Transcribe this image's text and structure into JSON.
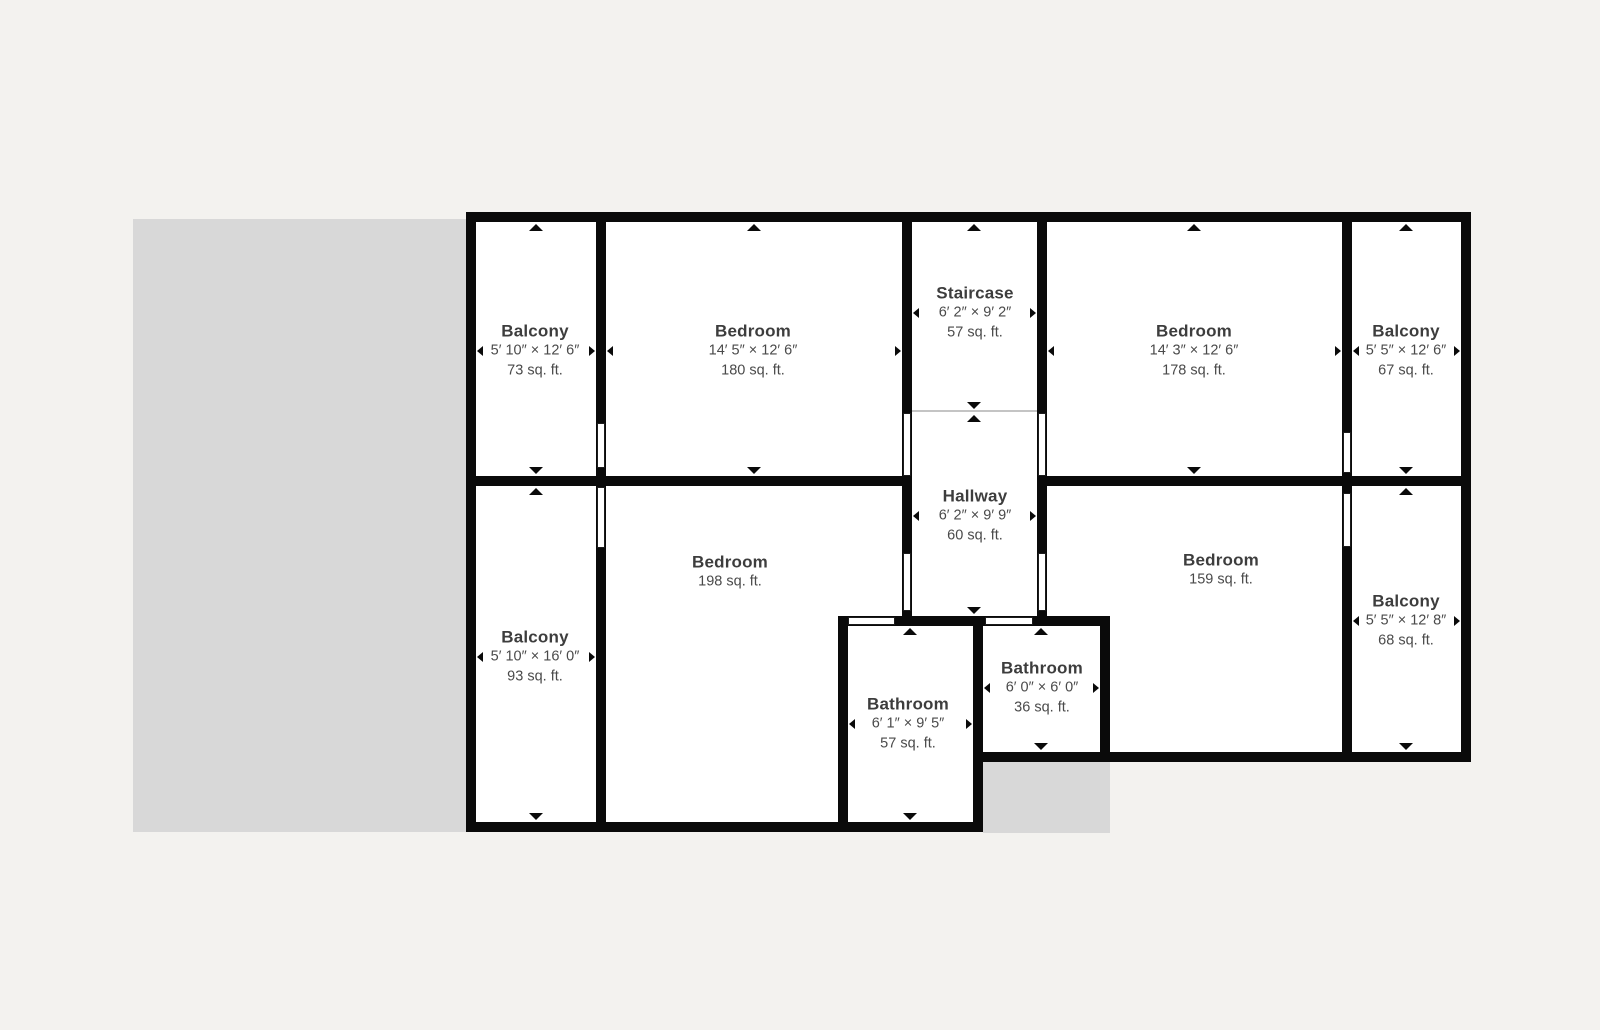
{
  "page": {
    "background_color": "#f3f2ef",
    "ground_color": "#d8d8d8",
    "wall_color": "#0a0a0a",
    "floor_color": "#ffffff",
    "title_text_color": "#3d3d3d",
    "detail_text_color": "#4a4a4a"
  },
  "rooms": [
    {
      "name": "Balcony",
      "dimensions": "5′ 10″ × 12′ 6″",
      "area": "73 sq. ft."
    },
    {
      "name": "Bedroom",
      "dimensions": "14′ 5″ × 12′ 6″",
      "area": "180 sq. ft."
    },
    {
      "name": "Staircase",
      "dimensions": "6′ 2″ × 9′ 2″",
      "area": "57 sq. ft."
    },
    {
      "name": "Bedroom",
      "dimensions": "14′ 3″ × 12′ 6″",
      "area": "178 sq. ft."
    },
    {
      "name": "Balcony",
      "dimensions": "5′ 5″ × 12′ 6″",
      "area": "67 sq. ft."
    },
    {
      "name": "Hallway",
      "dimensions": "6′ 2″ × 9′ 9″",
      "area": "60 sq. ft."
    },
    {
      "name": "Balcony",
      "dimensions": "5′ 10″ × 16′ 0″",
      "area": "93 sq. ft."
    },
    {
      "name": "Bedroom",
      "area": "198 sq. ft."
    },
    {
      "name": "Bathroom",
      "dimensions": "6′ 1″ × 9′ 5″",
      "area": "57 sq. ft."
    },
    {
      "name": "Bathroom",
      "dimensions": "6′ 0″ × 6′ 0″",
      "area": "36 sq. ft."
    },
    {
      "name": "Bedroom",
      "area": "159 sq. ft."
    },
    {
      "name": "Balcony",
      "dimensions": "5′ 5″ × 12′ 8″",
      "area": "68 sq. ft."
    }
  ]
}
